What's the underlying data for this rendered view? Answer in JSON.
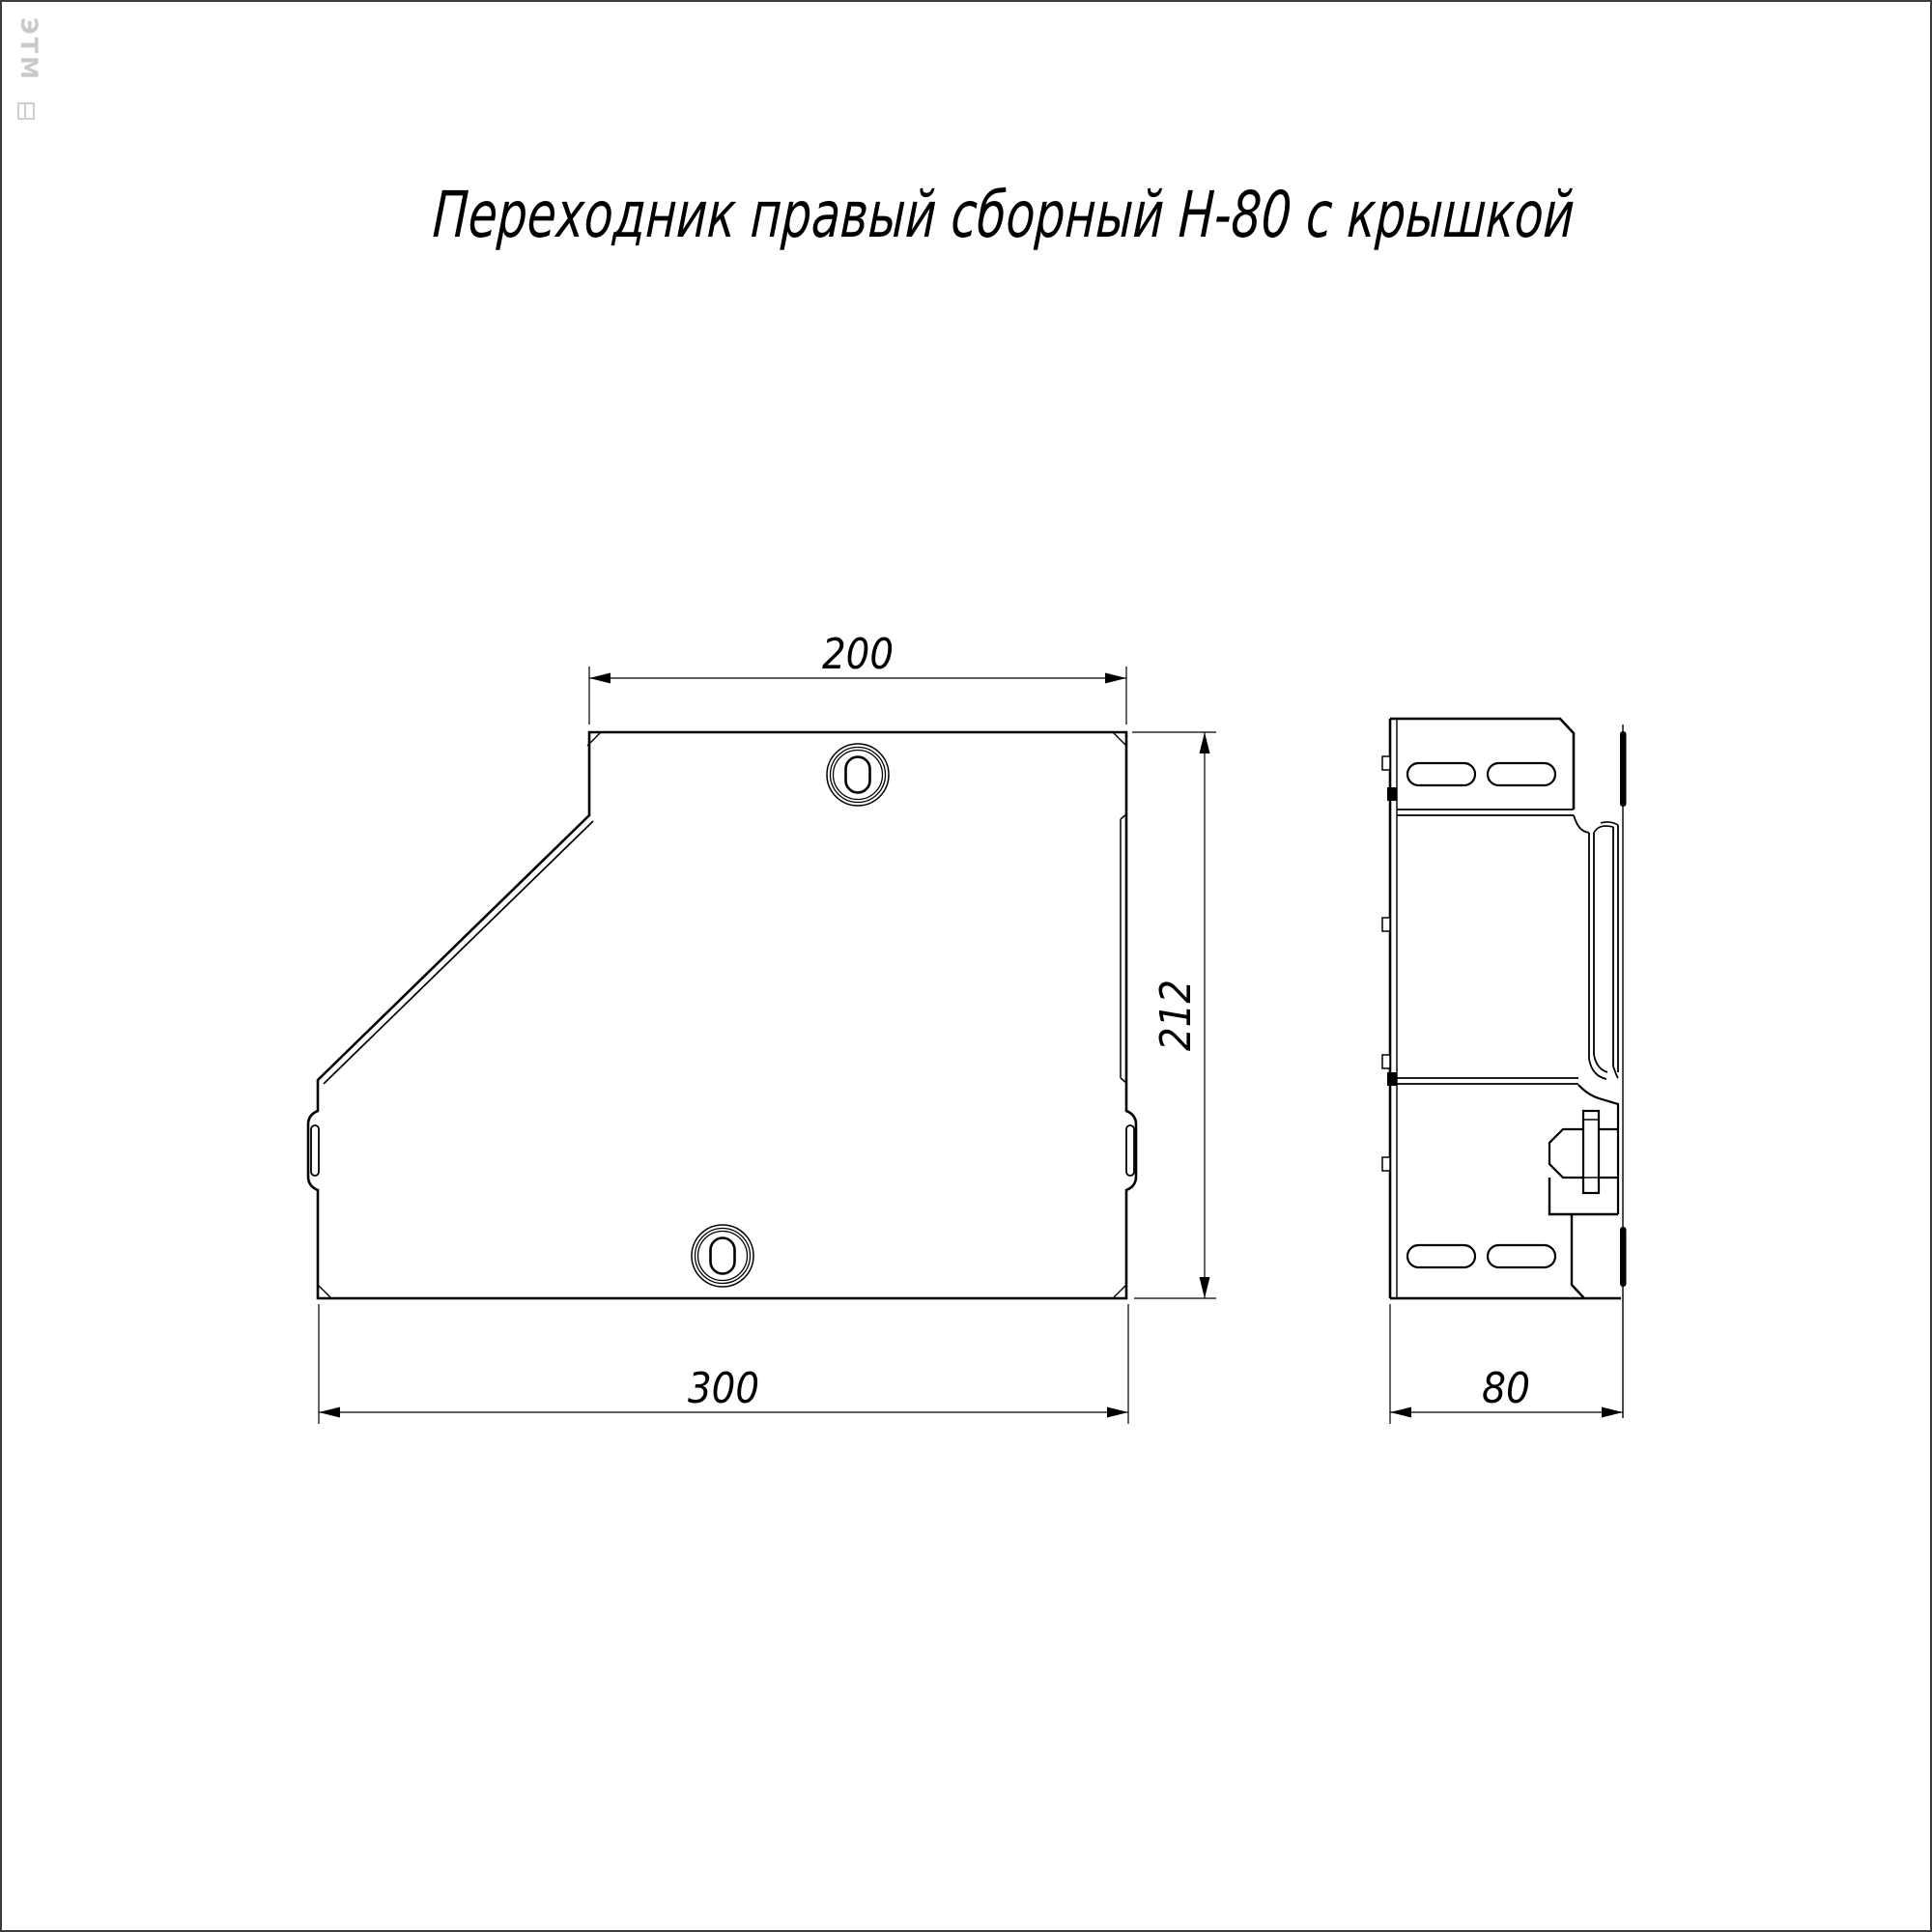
{
  "page": {
    "title": "Переходник правый сборный Н-80 с крышкой",
    "watermark": "ЭТМ"
  },
  "drawing": {
    "type": "technical-drawing",
    "views": {
      "front_view": "переходник, вид сбоку",
      "side_view": "переходник, вид с торца"
    }
  },
  "dimensions": {
    "top_width": "200",
    "height": "212",
    "bottom_width": "300",
    "side_width": "80"
  }
}
